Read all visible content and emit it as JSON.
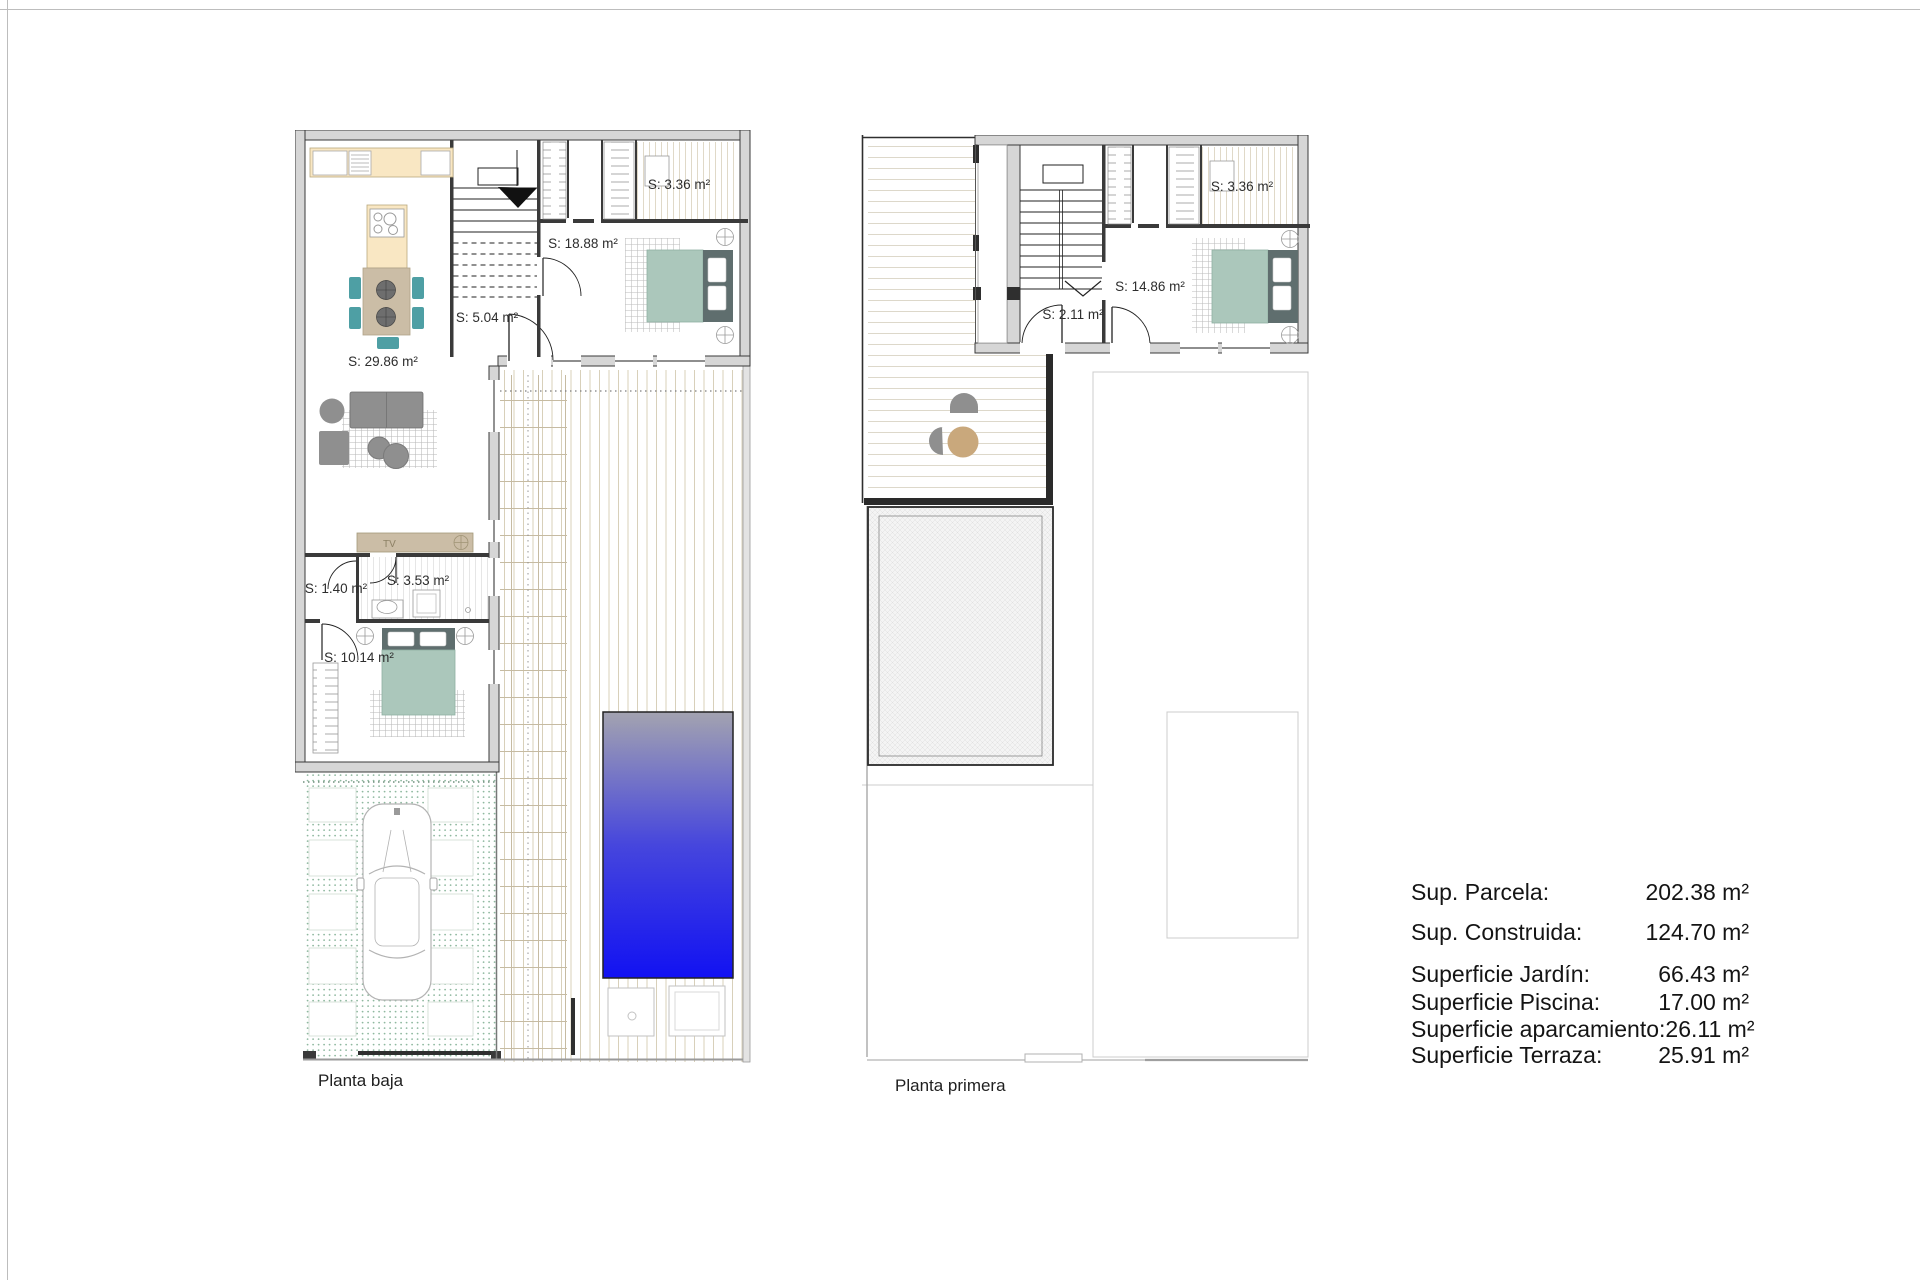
{
  "page": {
    "background": "#ffffff",
    "frame_color": "#bdbdbd"
  },
  "plans": {
    "ground": {
      "title": "Planta baja",
      "labels": {
        "living_kitchen": "S: 29.86 m²",
        "hall": "S: 18.88 m²",
        "vestibule": "S: 5.04 m²",
        "closet_main": "S: 3.36 m²",
        "closet_small": "S: 1.40 m²",
        "bathroom": "S: 3.53 m²",
        "bedroom": "S: 10.14 m²",
        "tv": "TV"
      }
    },
    "first": {
      "title": "Planta primera",
      "labels": {
        "hall": "S: 2.11 m²",
        "bedroom": "S: 14.86 m²",
        "closet": "S: 3.36 m²"
      }
    }
  },
  "legend": {
    "rows": [
      {
        "label": "Sup. Parcela:",
        "value": "202.38 m²"
      },
      {
        "label": "Sup. Construida:",
        "value": "124.70 m²"
      },
      {
        "label": "Superficie Jardín:",
        "value": "66.43 m²"
      },
      {
        "label": "Superficie Piscina:",
        "value": "17.00 m²"
      },
      {
        "label": "Superficie aparcamiento:",
        "value": "26.11 m²"
      },
      {
        "label": "Superficie Terraza:",
        "value": "25.91 m²"
      }
    ]
  },
  "colors": {
    "wall_fill": "#d6d6d6",
    "wall_line": "#3a3a3a",
    "kitchen_cream": "#f9e7c3",
    "wood_tan": "#cbbda6",
    "chair_teal": "#4e9fa4",
    "bed_mattress": "#abc7bb",
    "bed_frame": "#5f6e6e",
    "sofa_gray": "#8f8f8f",
    "pool_top": "#a3a3b0",
    "pool_bottom": "#1212f2",
    "garden_dot": "#8fb89f",
    "deck_line": "#d8d0ba",
    "pergola_line": "#c6bba2",
    "terrace_table_tan": "#c9a87c"
  }
}
